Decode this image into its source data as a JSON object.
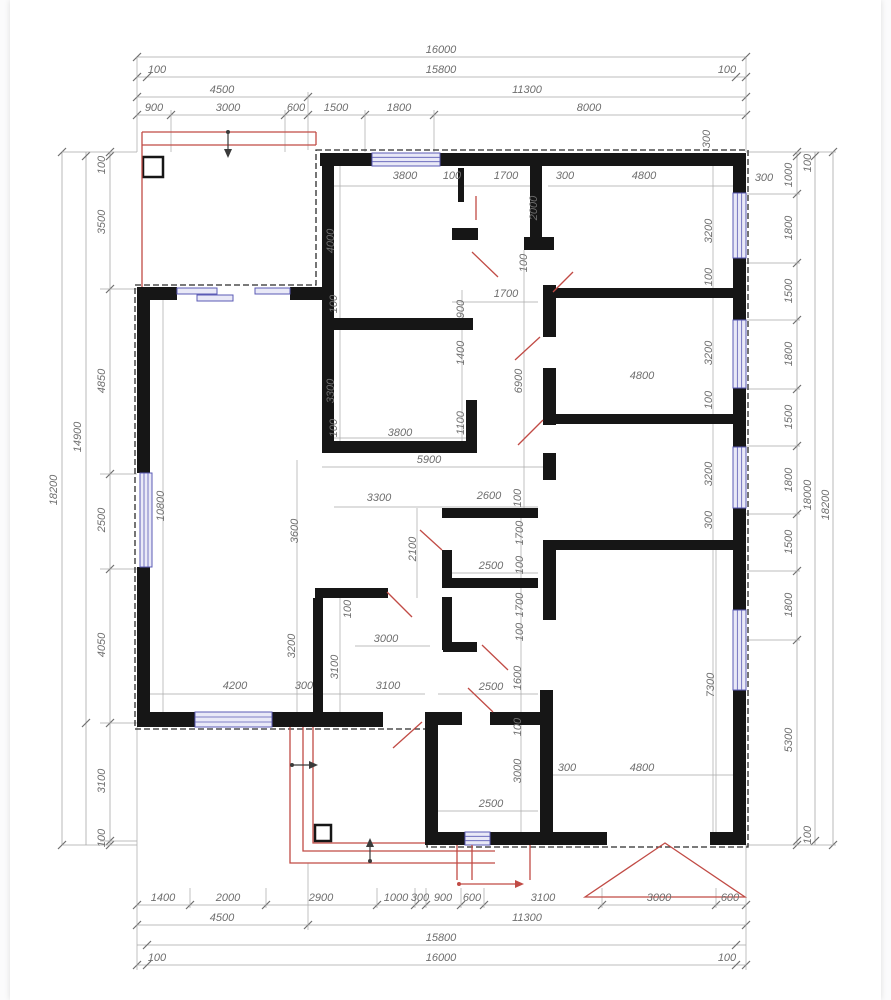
{
  "meta": {
    "title": "House floor plan with dimension chains (mm)",
    "overall_width_mm": "16000",
    "overall_height_mm": "18200"
  },
  "colors": {
    "paper": "#ffffff",
    "wall": "#161616",
    "dim_line": "#a8a8a8",
    "tick": "#6f6f6f",
    "text": "#6e6e6e",
    "red": "#c14b45",
    "dark": "#3a3a3a",
    "window_stroke": "#5b5bb5",
    "window_fill": "#e9e9f7",
    "outline": "#2b2b2b"
  },
  "plan": {
    "dashed_outline": "M316,150 H748 V847 H427 V729 H135 V285 H316 Z",
    "chains_h": [
      {
        "y": 57,
        "x1": 137,
        "x2": 746,
        "ticks": [
          137,
          746
        ]
      },
      {
        "y": 77,
        "x1": 137,
        "x2": 746,
        "ticks": [
          137,
          147,
          736,
          746
        ]
      },
      {
        "y": 97,
        "x1": 137,
        "x2": 746,
        "ticks": [
          137,
          308,
          746
        ]
      },
      {
        "y": 115,
        "x1": 137,
        "x2": 746,
        "ticks": [
          137,
          171,
          285,
          308,
          365,
          434,
          746
        ]
      },
      {
        "y": 905,
        "x1": 137,
        "x2": 746,
        "ticks": [
          137,
          190,
          266,
          377,
          415,
          426,
          461,
          484,
          602,
          716,
          746
        ]
      },
      {
        "y": 925,
        "x1": 137,
        "x2": 746,
        "ticks": [
          137,
          308,
          746
        ]
      },
      {
        "y": 945,
        "x1": 137,
        "x2": 746,
        "ticks": [
          147,
          736
        ]
      },
      {
        "y": 965,
        "x1": 137,
        "x2": 746,
        "ticks": [
          137,
          147,
          736,
          746
        ]
      }
    ],
    "chains_v": [
      {
        "x": 110,
        "y1": 152,
        "y2": 845,
        "ticks": [
          152,
          156,
          289,
          474,
          569,
          723,
          841,
          845
        ]
      },
      {
        "x": 86,
        "y1": 152,
        "y2": 845,
        "ticks": [
          156,
          723
        ]
      },
      {
        "x": 62,
        "y1": 152,
        "y2": 845,
        "ticks": [
          152,
          845
        ]
      },
      {
        "x": 797,
        "y1": 152,
        "y2": 845,
        "ticks": [
          152,
          156,
          194,
          263,
          320,
          389,
          446,
          514,
          571,
          640,
          841,
          845
        ]
      },
      {
        "x": 815,
        "y1": 152,
        "y2": 845,
        "ticks": [
          156,
          841
        ]
      },
      {
        "x": 833,
        "y1": 152,
        "y2": 845,
        "ticks": [
          152,
          845
        ]
      }
    ],
    "ext_lines": [
      [
        137,
        57,
        137,
        152
      ],
      [
        746,
        57,
        746,
        152
      ],
      [
        308,
        92,
        308,
        150
      ],
      [
        171,
        110,
        171,
        152
      ],
      [
        285,
        110,
        285,
        152
      ],
      [
        365,
        110,
        365,
        152
      ],
      [
        434,
        110,
        434,
        152
      ],
      [
        137,
        727,
        137,
        970
      ],
      [
        746,
        845,
        746,
        970
      ],
      [
        308,
        863,
        308,
        930
      ],
      [
        190,
        888,
        190,
        908
      ],
      [
        266,
        888,
        266,
        908
      ],
      [
        377,
        888,
        377,
        908
      ],
      [
        415,
        888,
        415,
        908
      ],
      [
        426,
        888,
        426,
        908
      ],
      [
        461,
        888,
        461,
        908
      ],
      [
        484,
        888,
        484,
        908
      ],
      [
        602,
        888,
        602,
        908
      ],
      [
        716,
        888,
        716,
        908
      ],
      [
        100,
        289,
        137,
        289
      ],
      [
        100,
        474,
        137,
        474
      ],
      [
        100,
        569,
        137,
        569
      ],
      [
        100,
        723,
        137,
        723
      ],
      [
        100,
        841,
        137,
        841
      ],
      [
        62,
        152,
        137,
        152
      ],
      [
        62,
        845,
        137,
        845
      ],
      [
        746,
        194,
        800,
        194
      ],
      [
        746,
        263,
        800,
        263
      ],
      [
        746,
        320,
        800,
        320
      ],
      [
        746,
        389,
        800,
        389
      ],
      [
        746,
        446,
        800,
        446
      ],
      [
        746,
        514,
        800,
        514
      ],
      [
        746,
        571,
        800,
        571
      ],
      [
        746,
        640,
        800,
        640
      ],
      [
        746,
        152,
        836,
        152
      ],
      [
        746,
        845,
        836,
        845
      ]
    ],
    "int_lines": [
      [
        334,
        186,
        530,
        186
      ],
      [
        548,
        186,
        733,
        186
      ],
      [
        452,
        302,
        538,
        302
      ],
      [
        334,
        438,
        466,
        438
      ],
      [
        322,
        467,
        546,
        467
      ],
      [
        334,
        507,
        538,
        507
      ],
      [
        443,
        573,
        538,
        573
      ],
      [
        355,
        646,
        430,
        646
      ],
      [
        438,
        694,
        538,
        694
      ],
      [
        150,
        694,
        425,
        694
      ],
      [
        548,
        775,
        733,
        775
      ],
      [
        438,
        811,
        538,
        811
      ],
      [
        524,
        250,
        524,
        508
      ],
      [
        462,
        290,
        462,
        441
      ],
      [
        536,
        166,
        536,
        250
      ],
      [
        713,
        166,
        713,
        832
      ],
      [
        340,
        166,
        340,
        453
      ],
      [
        297,
        460,
        297,
        712
      ],
      [
        340,
        598,
        340,
        712
      ],
      [
        163,
        300,
        163,
        712
      ],
      [
        716,
        550,
        716,
        832
      ],
      [
        521,
        508,
        521,
        712
      ],
      [
        417,
        508,
        417,
        598
      ],
      [
        521,
        712,
        521,
        832
      ]
    ],
    "walls": [
      [
        320,
        153,
        52,
        13
      ],
      [
        440,
        153,
        306,
        13
      ],
      [
        733,
        166,
        13,
        27
      ],
      [
        733,
        258,
        13,
        62
      ],
      [
        733,
        388,
        13,
        59
      ],
      [
        733,
        508,
        13,
        102
      ],
      [
        733,
        690,
        13,
        155
      ],
      [
        430,
        832,
        35,
        13
      ],
      [
        490,
        832,
        117,
        13
      ],
      [
        710,
        832,
        36,
        13
      ],
      [
        425,
        712,
        13,
        133
      ],
      [
        137,
        712,
        58,
        15
      ],
      [
        272,
        712,
        111,
        15
      ],
      [
        137,
        287,
        13,
        186
      ],
      [
        137,
        567,
        13,
        160
      ],
      [
        137,
        287,
        40,
        13
      ],
      [
        290,
        287,
        32,
        13
      ],
      [
        322,
        166,
        12,
        287
      ],
      [
        322,
        318,
        151,
        12
      ],
      [
        322,
        441,
        155,
        12
      ],
      [
        458,
        168,
        6,
        34
      ],
      [
        452,
        228,
        26,
        12
      ],
      [
        466,
        400,
        11,
        53
      ],
      [
        530,
        166,
        12,
        71
      ],
      [
        524,
        237,
        30,
        13
      ],
      [
        543,
        285,
        13,
        52
      ],
      [
        543,
        368,
        13,
        57
      ],
      [
        543,
        453,
        13,
        27
      ],
      [
        548,
        288,
        185,
        10
      ],
      [
        548,
        414,
        185,
        10
      ],
      [
        548,
        540,
        185,
        10
      ],
      [
        543,
        540,
        13,
        80
      ],
      [
        540,
        690,
        13,
        142
      ],
      [
        442,
        508,
        96,
        10
      ],
      [
        442,
        550,
        10,
        38
      ],
      [
        443,
        578,
        95,
        10
      ],
      [
        442,
        597,
        10,
        53
      ],
      [
        443,
        642,
        34,
        10
      ],
      [
        315,
        588,
        73,
        10
      ],
      [
        313,
        598,
        10,
        114
      ],
      [
        438,
        712,
        24,
        13
      ],
      [
        490,
        712,
        50,
        13
      ]
    ],
    "windows": [
      [
        372,
        153,
        68,
        13
      ],
      [
        140,
        473,
        12,
        94
      ],
      [
        195,
        712,
        77,
        15
      ],
      [
        465,
        832,
        25,
        13
      ],
      [
        733,
        193,
        13,
        65
      ],
      [
        733,
        320,
        13,
        68
      ],
      [
        733,
        447,
        13,
        61
      ],
      [
        733,
        610,
        13,
        80
      ]
    ],
    "blue_bars": [
      [
        177,
        288,
        40,
        6
      ],
      [
        197,
        295,
        36,
        6
      ],
      [
        255,
        288,
        35,
        6
      ]
    ],
    "red_lines": [
      [
        142,
        132,
        316,
        132
      ],
      [
        142,
        145,
        316,
        145
      ],
      [
        316,
        132,
        316,
        145
      ],
      [
        142,
        132,
        142,
        287
      ],
      [
        457,
        845,
        457,
        880
      ],
      [
        472,
        845,
        472,
        880
      ],
      [
        530,
        845,
        530,
        880
      ],
      [
        472,
        252,
        498,
        277
      ],
      [
        553,
        292,
        573,
        272
      ],
      [
        515,
        360,
        540,
        337
      ],
      [
        518,
        445,
        543,
        420
      ],
      [
        420,
        530,
        442,
        550
      ],
      [
        387,
        592,
        412,
        617
      ],
      [
        482,
        645,
        508,
        670
      ],
      [
        468,
        688,
        493,
        712
      ],
      [
        393,
        748,
        422,
        722
      ],
      [
        476,
        196,
        476,
        220
      ]
    ],
    "red_paths": [
      "M290,727 L290,863 L495,863",
      "M303,727 L303,851 L495,851",
      "M313,727 L313,843 L425,843",
      "M585,897 L665,843 L745,897 Z"
    ],
    "squares": [
      [
        143,
        157,
        20,
        20
      ],
      [
        315,
        825,
        16,
        16
      ]
    ],
    "arrows": [
      {
        "line": [
          228,
          133,
          228,
          155
        ],
        "head": "224,149 232,149 228,158",
        "dot": [
          228,
          132
        ],
        "c": "dark"
      },
      {
        "line": [
          292,
          765,
          316,
          765
        ],
        "head": "309,761 309,769 318,765",
        "dot": [
          292,
          765
        ],
        "c": "dark"
      },
      {
        "line": [
          370,
          861,
          370,
          840
        ],
        "head": "366,847 374,847 370,838",
        "dot": [
          370,
          861
        ],
        "c": "dark"
      },
      {
        "line": [
          459,
          884,
          522,
          884
        ],
        "head": "515,880 515,888 524,884",
        "dot": [
          459,
          884
        ],
        "c": "red"
      }
    ],
    "labels": [
      [
        "16000",
        441,
        53
      ],
      [
        "100",
        157,
        73
      ],
      [
        "15800",
        441,
        73
      ],
      [
        "100",
        727,
        73
      ],
      [
        "4500",
        222,
        93
      ],
      [
        "11300",
        527,
        93
      ],
      [
        "900",
        154,
        111
      ],
      [
        "3000",
        228,
        111
      ],
      [
        "600",
        296,
        111
      ],
      [
        "1500",
        336,
        111
      ],
      [
        "1800",
        399,
        111
      ],
      [
        "8000",
        589,
        111
      ],
      [
        "1400",
        163,
        901
      ],
      [
        "2000",
        228,
        901
      ],
      [
        "2900",
        321,
        901
      ],
      [
        "1000",
        396,
        901
      ],
      [
        "300",
        420,
        901
      ],
      [
        "900",
        443,
        901
      ],
      [
        "600",
        472,
        901
      ],
      [
        "3100",
        543,
        901
      ],
      [
        "3000",
        659,
        901
      ],
      [
        "600",
        730,
        901
      ],
      [
        "4500",
        222,
        921
      ],
      [
        "11300",
        527,
        921
      ],
      [
        "15800",
        441,
        941
      ],
      [
        "100",
        157,
        961
      ],
      [
        "16000",
        441,
        961
      ],
      [
        "100",
        727,
        961
      ],
      [
        "100",
        105,
        165,
        -90
      ],
      [
        "3500",
        105,
        222,
        -90
      ],
      [
        "4850",
        105,
        381,
        -90
      ],
      [
        "2500",
        105,
        520,
        -90
      ],
      [
        "4050",
        105,
        645,
        -90
      ],
      [
        "3100",
        105,
        781,
        -90
      ],
      [
        "100",
        105,
        838,
        -90
      ],
      [
        "14900",
        81,
        437,
        -90
      ],
      [
        "18200",
        57,
        490,
        -90
      ],
      [
        "1000",
        792,
        175,
        -90
      ],
      [
        "1800",
        792,
        228,
        -90
      ],
      [
        "1500",
        792,
        291,
        -90
      ],
      [
        "1800",
        792,
        354,
        -90
      ],
      [
        "1500",
        792,
        417,
        -90
      ],
      [
        "1800",
        792,
        480,
        -90
      ],
      [
        "1500",
        792,
        542,
        -90
      ],
      [
        "1800",
        792,
        605,
        -90
      ],
      [
        "5300",
        792,
        740,
        -90
      ],
      [
        "100",
        811,
        163,
        -90
      ],
      [
        "18000",
        811,
        495,
        -90
      ],
      [
        "100",
        811,
        835,
        -90
      ],
      [
        "18200",
        829,
        505,
        -90
      ],
      [
        "300",
        710,
        139,
        -90
      ],
      [
        "300",
        764,
        181
      ],
      [
        "3800",
        405,
        179
      ],
      [
        "100",
        452,
        179
      ],
      [
        "1700",
        506,
        179
      ],
      [
        "300",
        565,
        179
      ],
      [
        "4800",
        644,
        179
      ],
      [
        "4000",
        334,
        241,
        -90
      ],
      [
        "100",
        337,
        304,
        -90
      ],
      [
        "3300",
        334,
        391,
        -90
      ],
      [
        "100",
        337,
        428,
        -90
      ],
      [
        "3800",
        400,
        436
      ],
      [
        "5900",
        429,
        463
      ],
      [
        "2000",
        537,
        208,
        -90
      ],
      [
        "100",
        527,
        263,
        -90
      ],
      [
        "900",
        464,
        309,
        -90
      ],
      [
        "1400",
        464,
        353,
        -90
      ],
      [
        "1100",
        464,
        423,
        -90
      ],
      [
        "1700",
        506,
        297
      ],
      [
        "6900",
        522,
        381,
        -90
      ],
      [
        "3200",
        712,
        231,
        -90
      ],
      [
        "100",
        712,
        277,
        -90
      ],
      [
        "3200",
        712,
        353,
        -90
      ],
      [
        "100",
        712,
        400,
        -90
      ],
      [
        "3200",
        712,
        474,
        -90
      ],
      [
        "300",
        712,
        520,
        -90
      ],
      [
        "4800",
        642,
        379
      ],
      [
        "300",
        567,
        771
      ],
      [
        "4800",
        642,
        771
      ],
      [
        "7300",
        714,
        685,
        -90
      ],
      [
        "3300",
        379,
        501
      ],
      [
        "2600",
        489,
        499
      ],
      [
        "100",
        521,
        498,
        -90
      ],
      [
        "2100",
        416,
        549,
        -90
      ],
      [
        "2500",
        491,
        569
      ],
      [
        "1700",
        523,
        533,
        -90
      ],
      [
        "100",
        523,
        565,
        -90
      ],
      [
        "1700",
        523,
        605,
        -90
      ],
      [
        "100",
        523,
        632,
        -90
      ],
      [
        "100",
        351,
        609,
        -90
      ],
      [
        "3000",
        386,
        642
      ],
      [
        "3600",
        298,
        531,
        -90
      ],
      [
        "3200",
        295,
        646,
        -90
      ],
      [
        "3100",
        338,
        667,
        -90
      ],
      [
        "4200",
        235,
        689
      ],
      [
        "300",
        304,
        689
      ],
      [
        "3100",
        388,
        689
      ],
      [
        "2500",
        491,
        690
      ],
      [
        "1600",
        521,
        678,
        -90
      ],
      [
        "100",
        521,
        727,
        -90
      ],
      [
        "3000",
        521,
        771,
        -90
      ],
      [
        "2500",
        491,
        807
      ],
      [
        "10800",
        164,
        506,
        -90
      ]
    ]
  }
}
